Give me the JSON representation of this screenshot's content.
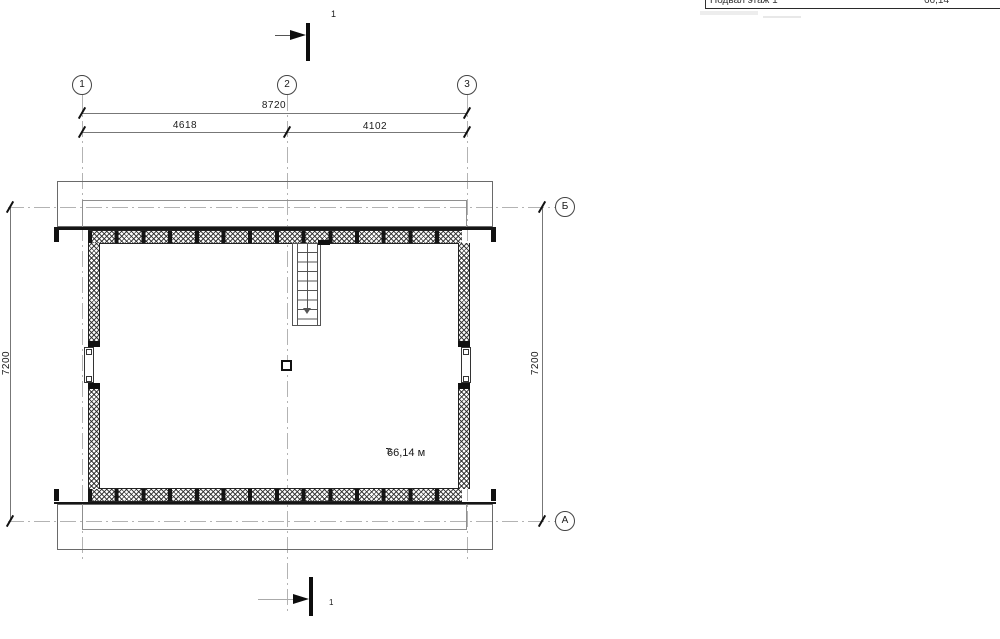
{
  "header_table": {
    "col1": "Подвал этаж 1",
    "col2": "66,14"
  },
  "section_marks": {
    "top_label": "1",
    "bottom_label": "1"
  },
  "grid": {
    "top": [
      "1",
      "2",
      "3"
    ],
    "right": [
      "Б",
      "А"
    ]
  },
  "dimensions": {
    "width_total": "8720",
    "width_left": "4618",
    "width_right": "4102",
    "height_left": "7200",
    "height_right": "7200"
  },
  "room": {
    "area_value": "66,14 м",
    "area_sup": "2"
  }
}
